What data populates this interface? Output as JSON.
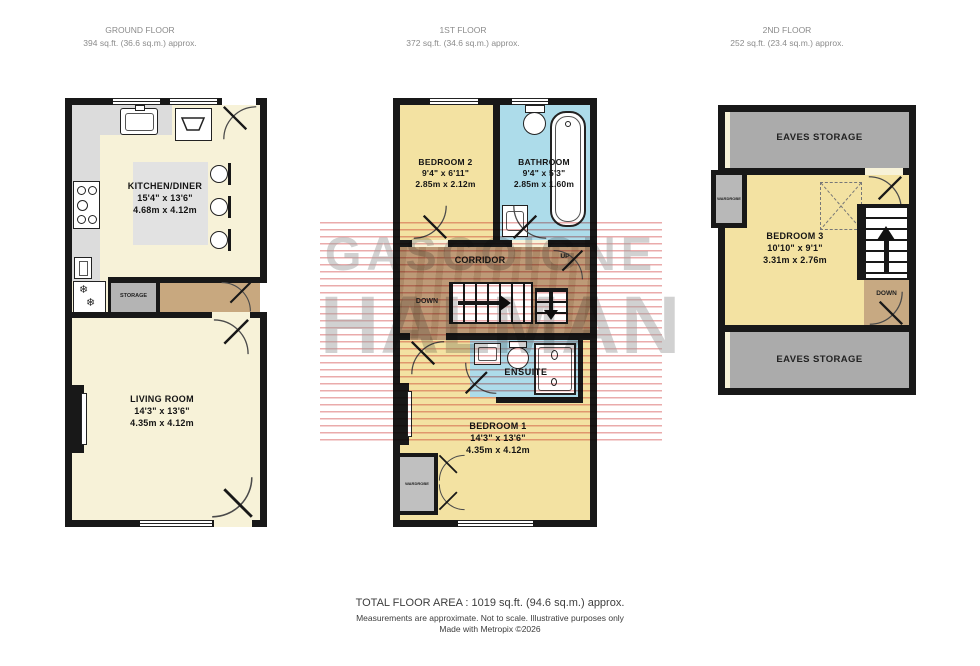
{
  "watermark": {
    "line1": "GASCOIGNE",
    "line2": "HALMAN"
  },
  "floors": {
    "ground": {
      "title": "GROUND FLOOR",
      "area": "394 sq.ft. (36.6 sq.m.) approx.",
      "rooms": {
        "kitchen": {
          "name": "KITCHEN/DINER",
          "imperial": "15'4\"  x  13'6\"",
          "metric": "4.68m  x  4.12m"
        },
        "storage": {
          "name": "STORAGE"
        },
        "living": {
          "name": "LIVING ROOM",
          "imperial": "14'3\"  x  13'6\"",
          "metric": "4.35m  x  4.12m"
        }
      }
    },
    "first": {
      "title": "1ST FLOOR",
      "area": "372 sq.ft. (34.6 sq.m.) approx.",
      "rooms": {
        "bedroom2": {
          "name": "BEDROOM 2",
          "imperial": "9'4\"  x  6'11\"",
          "metric": "2.85m  x  2.12m"
        },
        "bathroom": {
          "name": "BATHROOM",
          "imperial": "9'4\"  x  5'3\"",
          "metric": "2.85m  x  1.60m"
        },
        "corridor": {
          "name": "CORRIDOR"
        },
        "ensuite": {
          "name": "ENSUITE"
        },
        "bedroom1": {
          "name": "BEDROOM 1",
          "imperial": "14'3\"  x  13'6\"",
          "metric": "4.35m  x  4.12m"
        },
        "wardrobe": {
          "name": "WARDROBE"
        }
      },
      "stairs": {
        "down_label": "DOWN",
        "up_label": "UP"
      }
    },
    "second": {
      "title": "2ND FLOOR",
      "area": "252 sq.ft. (23.4 sq.m.) approx.",
      "rooms": {
        "eaves_top": {
          "name": "EAVES STORAGE"
        },
        "bedroom3": {
          "name": "BEDROOM 3",
          "imperial": "10'10\"  x  9'1\"",
          "metric": "3.31m  x  2.76m"
        },
        "eaves_bottom": {
          "name": "EAVES STORAGE"
        },
        "wardrobe": {
          "name": "WARDROBE"
        }
      },
      "stairs": {
        "down_label": "DOWN"
      }
    }
  },
  "footer": {
    "total": "TOTAL FLOOR AREA : 1019 sq.ft. (94.6 sq.m.) approx.",
    "disclaimer": "Measurements are approximate.  Not to scale.  Illustrative purposes only",
    "credit": "Made with Metropix ©2026"
  },
  "colors": {
    "wall": "#181818",
    "floor_cream": "#f7f2d8",
    "bedroom_yellow": "#f3e2a2",
    "bathroom_blue": "#addcea",
    "corridor_wood": "#bd9a77",
    "hall_wood": "#c8a87f",
    "storage_gray": "#b4b4b4",
    "eaves_gray": "#ababab",
    "counter_gray": "#dcdcdc",
    "table_gray": "#e2e2e2",
    "watermark_red": "#d65858",
    "watermark_gray": "#9e9e9e"
  }
}
